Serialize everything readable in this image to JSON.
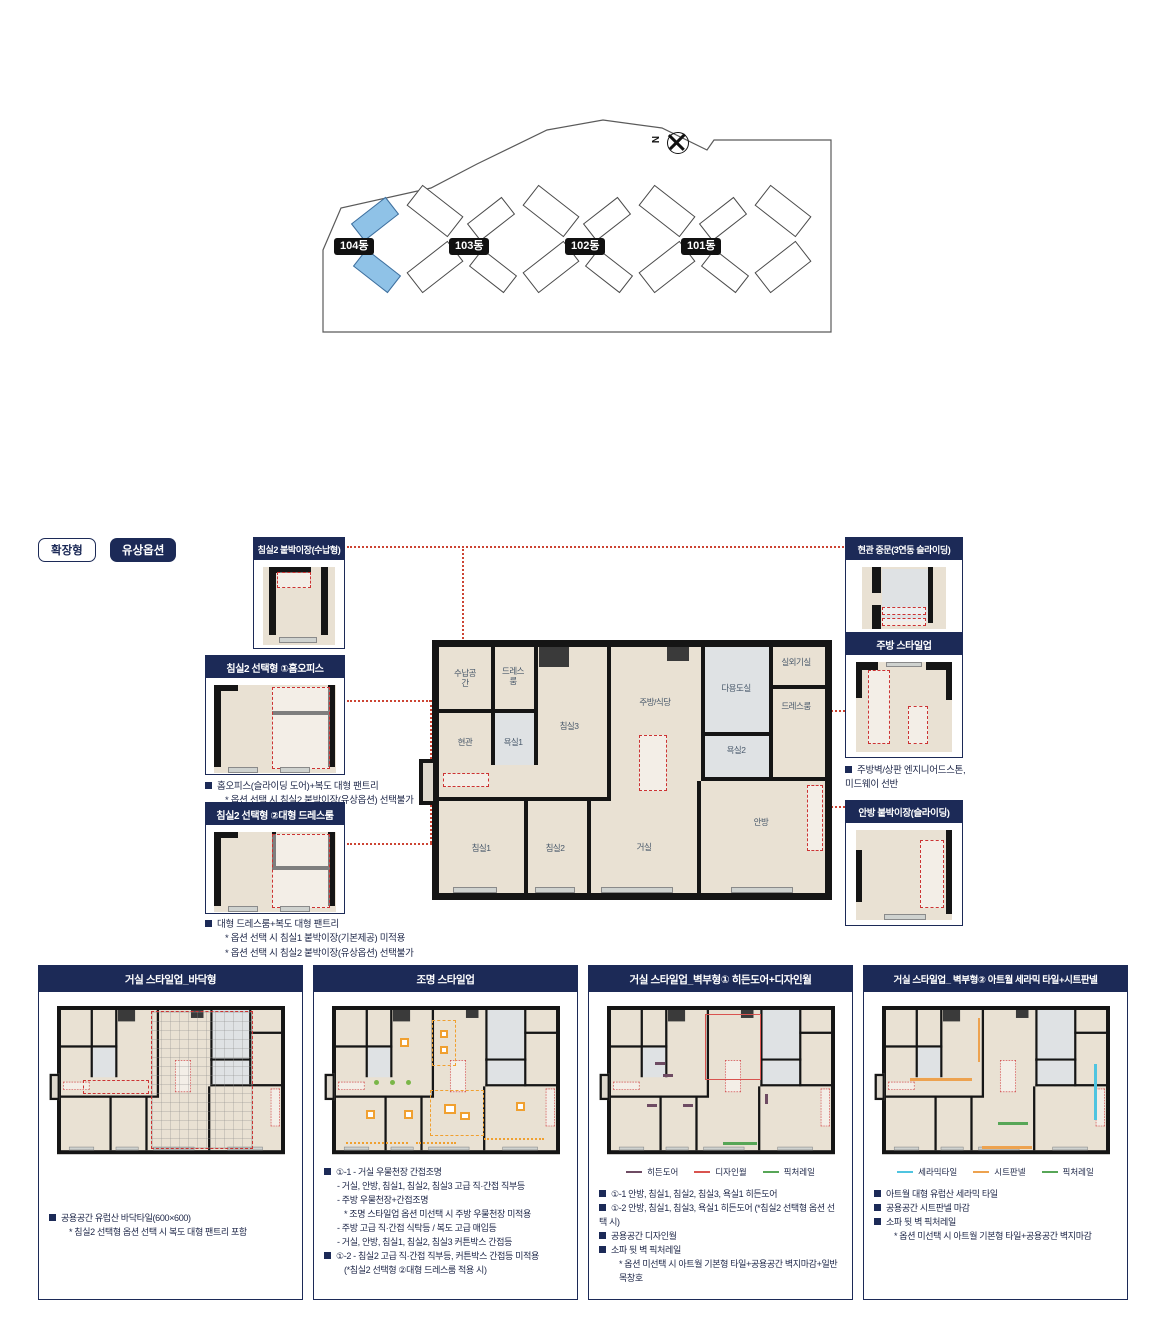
{
  "site_plan": {
    "compass_label": "N",
    "buildings": [
      {
        "label": "104동",
        "highlight": true
      },
      {
        "label": "103동",
        "highlight": false
      },
      {
        "label": "102동",
        "highlight": false
      },
      {
        "label": "101동",
        "highlight": false
      }
    ],
    "highlight_color": "#8fc2e7"
  },
  "badges": {
    "type_label": "확장형",
    "option_label": "유상옵션"
  },
  "colors": {
    "navy": "#1c2a57",
    "leader_red": "#cc3333",
    "floor_beige": "#e9e1d3"
  },
  "floor_plan": {
    "rooms": [
      "수납공간",
      "드레스룸",
      "현관",
      "욕실1",
      "침실3",
      "주방/식당",
      "다용도실",
      "실외기실",
      "드레스룸",
      "욕실2",
      "침실1",
      "침실2",
      "거실",
      "안방"
    ]
  },
  "callouts": {
    "left": [
      {
        "title": "침실2 붙박이장(수납형)",
        "notes": []
      },
      {
        "title": "침실2 선택형 ①홈오피스",
        "notes": [
          {
            "t": "b",
            "text": "홈오피스(슬라이딩 도어)+복도 대형 팬트리"
          },
          {
            "t": "s",
            "text": "* 옵션 선택 시 침실2 붙박이장(유상옵션) 선택불가"
          }
        ]
      },
      {
        "title": "침실2 선택형 ②대형 드레스룸",
        "notes": [
          {
            "t": "b",
            "text": "대형 드레스룸+복도 대형 팬트리"
          },
          {
            "t": "s",
            "text": "* 옵션 선택 시 침실1 붙박이장(기본제공) 미적용"
          },
          {
            "t": "s",
            "text": "* 옵션 선택 시 침실2 붙박이장(유상옵션) 선택불가"
          }
        ]
      }
    ],
    "right": [
      {
        "title": "현관 중문(3연동 슬라이딩)",
        "notes": []
      },
      {
        "title": "주방 스타일업",
        "notes": [
          {
            "t": "b",
            "text": "주방벽/상판 엔지니어드스톤, 미드웨이 선반"
          }
        ]
      },
      {
        "title": "안방 붙박이장(슬라이딩)",
        "notes": []
      }
    ]
  },
  "panels": [
    {
      "title": "거실 스타일업_바닥형",
      "legend": [],
      "lines": [
        {
          "t": "b",
          "text": "공용공간 유럽산 바닥타일(600×600)"
        },
        {
          "t": "s",
          "text": "* 침실2 선택형 옵션 선택 시 복도 대형 팬트리 포함"
        }
      ]
    },
    {
      "title": "조명 스타일업",
      "legend": [],
      "lines": [
        {
          "t": "b",
          "text": "①-1 - 거실 우물천장 간접조명"
        },
        {
          "t": "d",
          "text": "- 거실, 안방, 침실1, 침실2, 침실3 고급 직·간접 직부등"
        },
        {
          "t": "d",
          "text": "- 주방 우물천장+간접조명"
        },
        {
          "t": "s",
          "text": "* 조명 스타일업 옵션 미선택 시 주방 우물천장 미적용"
        },
        {
          "t": "d",
          "text": "- 주방 고급 직·간접 식탁등 / 복도 고급 매입등"
        },
        {
          "t": "d",
          "text": "- 거실, 안방, 침실1, 침실2, 침실3 커튼박스 간접등"
        },
        {
          "t": "b",
          "text": "①-2 - 침실2 고급 직·간접 직부등, 커튼박스 간접등 미적용"
        },
        {
          "t": "s",
          "text": "(*침실2 선택형 ②대형 드레스룸 적용 시)"
        }
      ]
    },
    {
      "title": "거실 스타일업_벽부형① 히든도어+디자인월",
      "legend": [
        {
          "label": "히든도어",
          "color": "#6e4b63"
        },
        {
          "label": "디자인월",
          "color": "#d9534f"
        },
        {
          "label": "픽처레일",
          "color": "#57a657"
        }
      ],
      "lines": [
        {
          "t": "b",
          "text": "①-1 안방, 침실1, 침실2, 침실3, 욕실1 히든도어"
        },
        {
          "t": "b",
          "text": "①-2 안방, 침실1, 침실3, 욕실1 히든도어 (*침실2 선택형 옵션 선택 시)"
        },
        {
          "t": "b",
          "text": "공용공간 디자인월"
        },
        {
          "t": "b",
          "text": "소파 뒷 벽 픽처레일"
        },
        {
          "t": "s",
          "text": "* 옵션 미선택 시 아트월 기본형 타일+공용공간 벽지마감+일반 목창호"
        }
      ]
    },
    {
      "title": "거실 스타일업_ 벽부형② 아트월 세라믹 타일+시트판넬",
      "legend": [
        {
          "label": "세라믹타일",
          "color": "#4fc4e0"
        },
        {
          "label": "시트판넬",
          "color": "#eda24f"
        },
        {
          "label": "픽처레일",
          "color": "#57a657"
        }
      ],
      "lines": [
        {
          "t": "b",
          "text": "아트월 대형 유럽산 세라믹 타일"
        },
        {
          "t": "b",
          "text": "공용공간 시트판넬 마감"
        },
        {
          "t": "b",
          "text": "소파 뒷 벽 픽처레일"
        },
        {
          "t": "s",
          "text": "* 옵션 미선택 시 아트월 기본형 타일+공용공간 벽지마감"
        }
      ]
    }
  ]
}
